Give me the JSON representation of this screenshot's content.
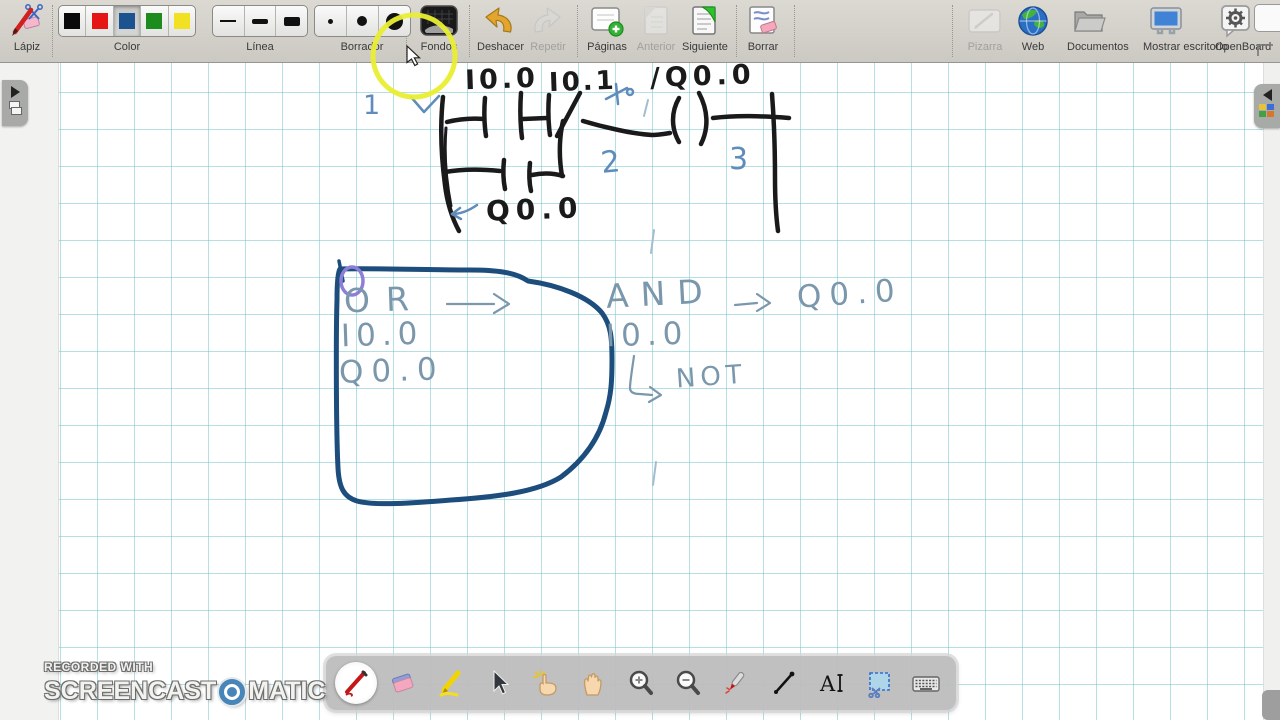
{
  "app": {
    "title": "OpenBoard"
  },
  "colors": {
    "grid": "#79c7cc",
    "ink_black": "#1a1a1a",
    "ink_blue": "#5f8cba",
    "ink_lightblue": "#7b97ac",
    "ink_darkblue": "#1c4d7c",
    "ink_purple": "#8d7fd8",
    "highlight_ring": "#e9ee32"
  },
  "toolbar": {
    "lapiz": {
      "label": "Lápiz"
    },
    "color": {
      "label": "Color",
      "swatches": [
        "#0a0a0a",
        "#e51515",
        "#1a538f",
        "#1c8c1c",
        "#f2e023"
      ],
      "selected_index": 2
    },
    "linea": {
      "label": "Línea"
    },
    "borrador": {
      "label": "Borrador"
    },
    "fondos": {
      "label": "Fondos"
    },
    "deshacer": {
      "label": "Deshacer"
    },
    "repetir": {
      "label": "Repetir"
    },
    "paginas": {
      "label": "Páginas"
    },
    "anterior": {
      "label": "Anterior"
    },
    "siguiente": {
      "label": "Siguiente"
    },
    "borrar": {
      "label": "Borrar"
    },
    "pizarra": {
      "label": "Pizarra"
    },
    "web": {
      "label": "Web"
    },
    "documentos": {
      "label": "Documentos"
    },
    "mostrar_escritorio": {
      "label": "Mostrar escritorio"
    },
    "openboard": {
      "label": "OpenBoard"
    }
  },
  "whiteboard": {
    "ladder": {
      "contact1": "I0.0",
      "contact2": "I0.1",
      "coil": "/Q0.0",
      "branch_contact": "Q0.0",
      "marks": [
        "1",
        "2",
        "3"
      ]
    },
    "notes": {
      "or_title": "OR",
      "or_input1": "I0.0",
      "or_input2": "Q0.0",
      "and_title": "AND",
      "and_output": "Q0.0",
      "and_input": "I0.0",
      "not_label": "NOT"
    }
  },
  "dock": {
    "selected": "pen-tool",
    "tools": [
      "pen-tool",
      "eraser-tool",
      "highlighter-tool",
      "selector-tool",
      "interact-tool",
      "hand-tool",
      "zoom-in-tool",
      "zoom-out-tool",
      "laser-pointer-tool",
      "line-tool",
      "text-tool",
      "capture-tool",
      "virtual-keyboard-tool"
    ]
  },
  "watermark": {
    "recorded_with": "RECORDED WITH",
    "brand_left": "SCREENCAST",
    "brand_right": "MATIC"
  }
}
